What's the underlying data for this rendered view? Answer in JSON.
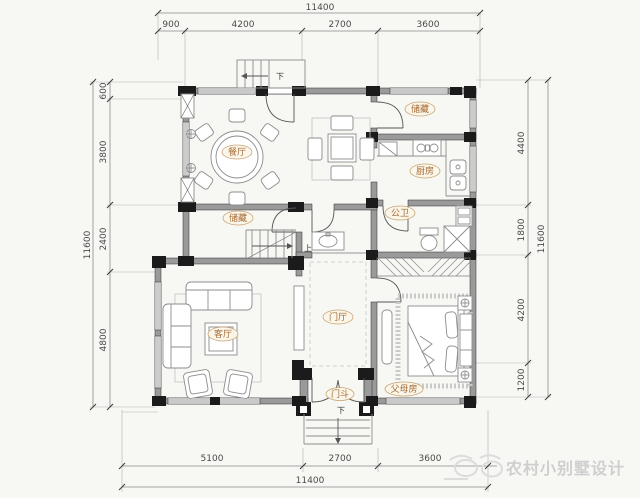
{
  "watermark": {
    "brand": "农村小别墅设计"
  },
  "rooms": {
    "dining": "餐厅",
    "storage_top": "储藏",
    "kitchen": "厨房",
    "bath": "公卫",
    "storage_mid": "储藏",
    "foyer": "门厅",
    "living": "客厅",
    "parents_room": "父母房",
    "vestibule": "门斗"
  },
  "stairs": {
    "down_top": "下",
    "up_mid": "上",
    "down_entry": "下"
  },
  "dims": {
    "top_total": "11400",
    "top": [
      "900",
      "4200",
      "2700",
      "3600"
    ],
    "left_total": "11600",
    "left": [
      "600",
      "3800",
      "2400",
      "4800"
    ],
    "right_total": "11600",
    "right": [
      "4400",
      "1800",
      "4200",
      "1200"
    ],
    "bottom_total": "11400",
    "bottom": [
      "5100",
      "2700",
      "3600"
    ]
  },
  "colors": {
    "bg": "#f7f7f4",
    "wall_column": "#1b1b1b",
    "wall_run": "#9a9a9a",
    "dim_text": "#4a4a4a",
    "room_label": "#a66a32",
    "room_label_stroke": "#c8a06b",
    "watermark": "#cfcfcf"
  }
}
